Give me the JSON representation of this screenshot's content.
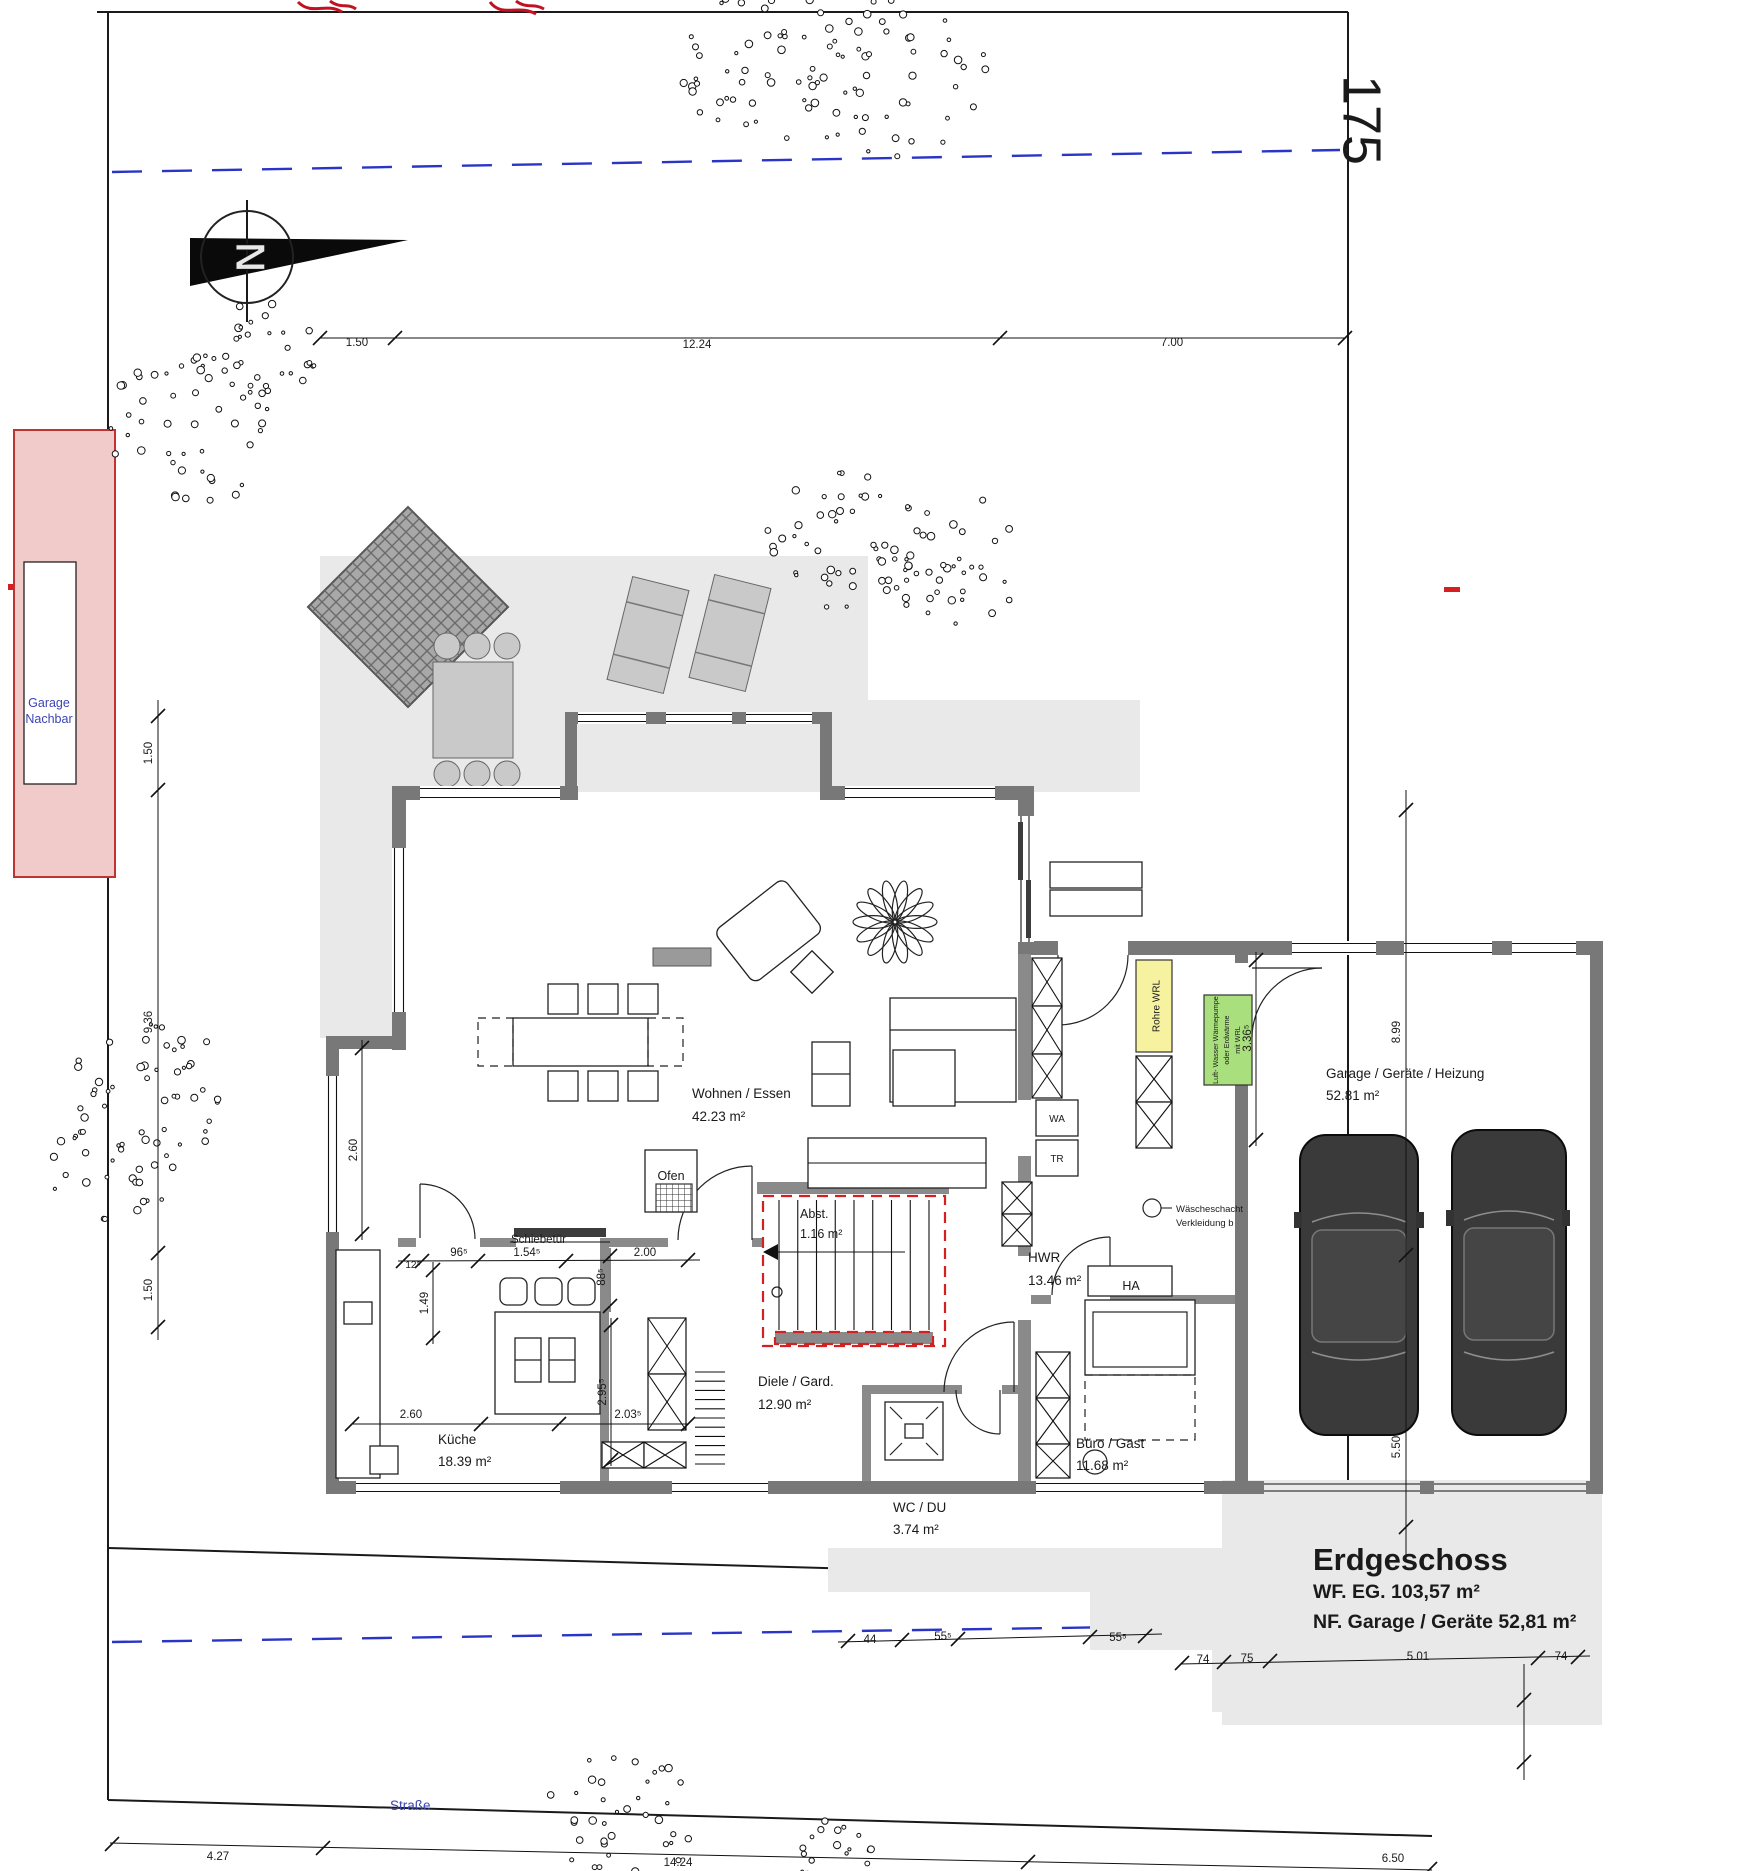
{
  "plot": {
    "number": "175",
    "street_label": "Straße",
    "neighbor_garage_line1": "Garage",
    "neighbor_garage_line2": "Nachbar",
    "north_letter": "N"
  },
  "title_block": {
    "title": "Erdgeschoss",
    "wf_line": "WF. EG. 103,57 m²",
    "nf_line": "NF. Garage / Geräte 52,81 m²"
  },
  "rooms": {
    "wohnen_essen": {
      "name": "Wohnen / Essen",
      "area": "42.23 m²"
    },
    "kueche": {
      "name": "Küche",
      "area": "18.39 m²"
    },
    "diele": {
      "name": "Diele / Gard.",
      "area": "12.90 m²"
    },
    "hwr": {
      "name": "HWR",
      "area": "13.46 m²"
    },
    "wc_du": {
      "name": "WC / DU",
      "area": "3.74 m²"
    },
    "buero_gast": {
      "name": "Büro / Gast",
      "area": "11.68 m²"
    },
    "abstellraum": {
      "name": "Abst.",
      "area": "1.16 m²"
    },
    "garage": {
      "name": "Garage / Geräte / Heizung",
      "area": "52.81 m²"
    }
  },
  "fixtures": {
    "ofen": "Ofen",
    "schiebetuer": "Schiebetür",
    "hausanschluss": "HA",
    "waschmaschine": "WA",
    "trockner": "TR",
    "rohre_wrl": "Rohre WRL",
    "waermepumpe_line1": "Luft- Wasser Wärmepumpe",
    "waermepumpe_line2": "oder Erdwärme",
    "waermepumpe_line3": "mit WRL",
    "waescheschacht_line1": "Wäscheschacht",
    "waescheschacht_line2": "Verkleidung b"
  },
  "dims": {
    "top": [
      "1.50",
      "12.24",
      "7.00"
    ],
    "left": [
      "1.50",
      "9.36",
      "1.50"
    ],
    "right": [
      "8.99",
      "5.50"
    ],
    "interior": [
      "12⁵",
      "96⁵",
      "1.54⁵",
      "2.00",
      "1.49",
      "88⁵",
      "2.60",
      "2.60",
      "2.03⁵",
      "2.95⁵",
      "3.36⁵"
    ],
    "mid_bottom": [
      "44",
      "55⁵",
      "55⁵"
    ],
    "garage_bottom": [
      "74",
      "75",
      "5.01",
      "74"
    ],
    "bottom": [
      "4.27",
      "14.24",
      "6.50"
    ]
  },
  "colors": {
    "wall_gray": "#787878",
    "terrace_gray": "#e9e9e9",
    "accent_yellow": "#f6f2a0",
    "accent_green": "#a9e07d",
    "neighbor_pink": "#f1caca",
    "blue_label": "#3a45b4",
    "marker_red": "#d42020",
    "boundary_blue": "#2a35c8"
  }
}
